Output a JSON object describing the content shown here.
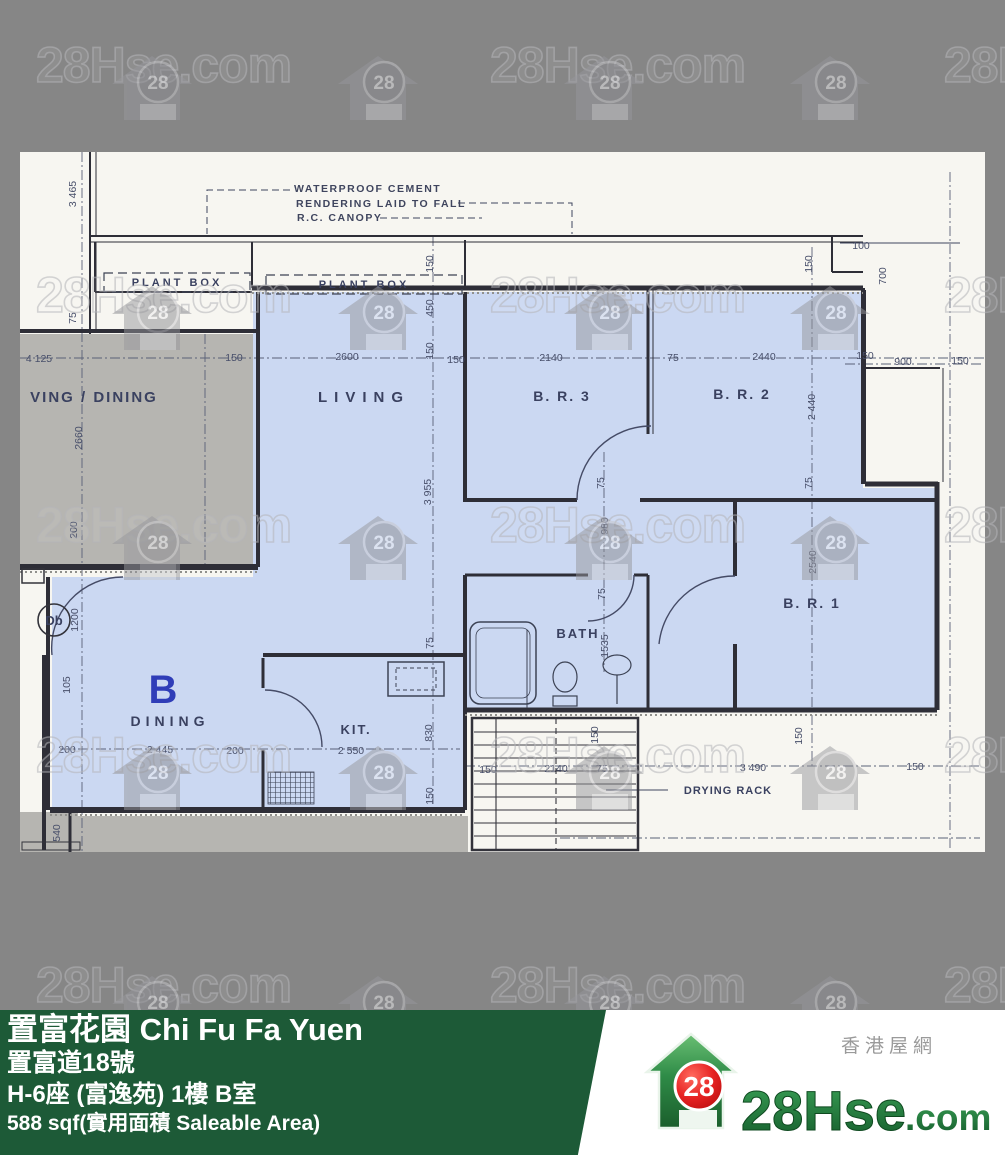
{
  "colors": {
    "page_bg": "#868686",
    "paper": "#f7f6f1",
    "unit_highlight_blue": "#cbd8f2",
    "neighbor_gray": "#b6b5b1",
    "wall_line": "#2e2e37",
    "footer_green": "#1d5a37",
    "brand_green": "#1f7a3c",
    "brand_red": "#d71a1a"
  },
  "watermark": {
    "text": "28Hse.com",
    "badge": "28",
    "rows_y": [
      38,
      268,
      498,
      728,
      958
    ],
    "text_x": [
      36,
      490,
      944
    ],
    "house_x": [
      112,
      338,
      564,
      790
    ]
  },
  "floorplan": {
    "unit_label": {
      "t": "B",
      "x": 143,
      "y": 551
    },
    "door_bell": {
      "t": "Db",
      "x": 34,
      "y": 473,
      "cx": 34,
      "cy": 468,
      "r": 16
    },
    "room_labels": [
      {
        "t": "LIVING",
        "x": 344,
        "y": 250,
        "fs": 15,
        "ls": 7
      },
      {
        "t": "B. R. 3",
        "x": 542,
        "y": 249,
        "fs": 14,
        "ls": 2
      },
      {
        "t": "B. R. 2",
        "x": 722,
        "y": 247,
        "fs": 14,
        "ls": 2
      },
      {
        "t": "B. R. 1",
        "x": 792,
        "y": 456,
        "fs": 14,
        "ls": 2
      },
      {
        "t": "BATH",
        "x": 558,
        "y": 486,
        "fs": 13,
        "ls": 2
      },
      {
        "t": "DINING",
        "x": 150,
        "y": 574,
        "fs": 14,
        "ls": 5
      },
      {
        "t": "KIT.",
        "x": 336,
        "y": 582,
        "fs": 13,
        "ls": 2
      },
      {
        "t": "VING / DINING",
        "x": 74,
        "y": 250,
        "fs": 15,
        "ls": 2
      },
      {
        "t": "PLANT BOX",
        "x": 157,
        "y": 134,
        "fs": 11,
        "ls": 3
      },
      {
        "t": "PLANT BOX",
        "x": 344,
        "y": 136,
        "fs": 11,
        "ls": 3
      },
      {
        "t": "DRYING RACK",
        "x": 708,
        "y": 642,
        "fs": 11,
        "ls": 1
      }
    ],
    "notes": [
      {
        "t": "WATERPROOF CEMENT",
        "x": 274,
        "y": 40
      },
      {
        "t": "RENDERING LAID TO FALL",
        "x": 276,
        "y": 55
      },
      {
        "t": "R.C. CANOPY",
        "x": 277,
        "y": 69
      }
    ],
    "dims_h": [
      [
        "4 125",
        19,
        210
      ],
      [
        "150",
        214,
        209
      ],
      [
        "2600",
        327,
        208
      ],
      [
        "150",
        436,
        211
      ],
      [
        "2140",
        531,
        209
      ],
      [
        "75",
        653,
        209
      ],
      [
        "2440",
        744,
        208
      ],
      [
        "150",
        845,
        207
      ],
      [
        "900",
        883,
        213
      ],
      [
        "150",
        940,
        212
      ],
      [
        "100",
        841,
        97
      ],
      [
        "150",
        468,
        621
      ],
      [
        "2140",
        536,
        620
      ],
      [
        "75",
        582,
        620
      ],
      [
        "3 490",
        733,
        619
      ],
      [
        "150",
        895,
        618
      ],
      [
        "200",
        47,
        601
      ],
      [
        "2 445",
        140,
        601
      ],
      [
        "200",
        215,
        602
      ],
      [
        "2 550",
        331,
        602
      ]
    ],
    "dims_v": [
      [
        "3 465",
        56,
        42
      ],
      [
        "75",
        56,
        166
      ],
      [
        "2660",
        62,
        286
      ],
      [
        "200",
        57,
        378
      ],
      [
        "1200",
        58,
        468
      ],
      [
        "105",
        50,
        533
      ],
      [
        "540",
        40,
        681
      ],
      [
        "150",
        413,
        112
      ],
      [
        "450",
        413,
        156
      ],
      [
        "150",
        413,
        199
      ],
      [
        "3 955",
        411,
        340
      ],
      [
        "75",
        413,
        491
      ],
      [
        "830",
        412,
        581
      ],
      [
        "150",
        413,
        644
      ],
      [
        "75",
        584,
        331
      ],
      [
        "980",
        588,
        374
      ],
      [
        "75",
        585,
        442
      ],
      [
        "1535",
        588,
        494
      ],
      [
        "150",
        578,
        583
      ],
      [
        "150",
        792,
        112
      ],
      [
        "2 440",
        795,
        255
      ],
      [
        "75",
        792,
        331
      ],
      [
        "2540",
        796,
        410
      ],
      [
        "150",
        782,
        584
      ],
      [
        "700",
        866,
        124
      ]
    ]
  },
  "footer": {
    "building": "置富花園 Chi Fu Fa Yuen",
    "street": "置富道18號",
    "block": "H-6座 (富逸苑) 1樓 B室",
    "area": "588 sqf(實用面積 Saleable Area)",
    "brand": {
      "tagline": "香港屋網",
      "name_main": "28Hse",
      "name_suffix": ".com",
      "badge": "28"
    }
  }
}
